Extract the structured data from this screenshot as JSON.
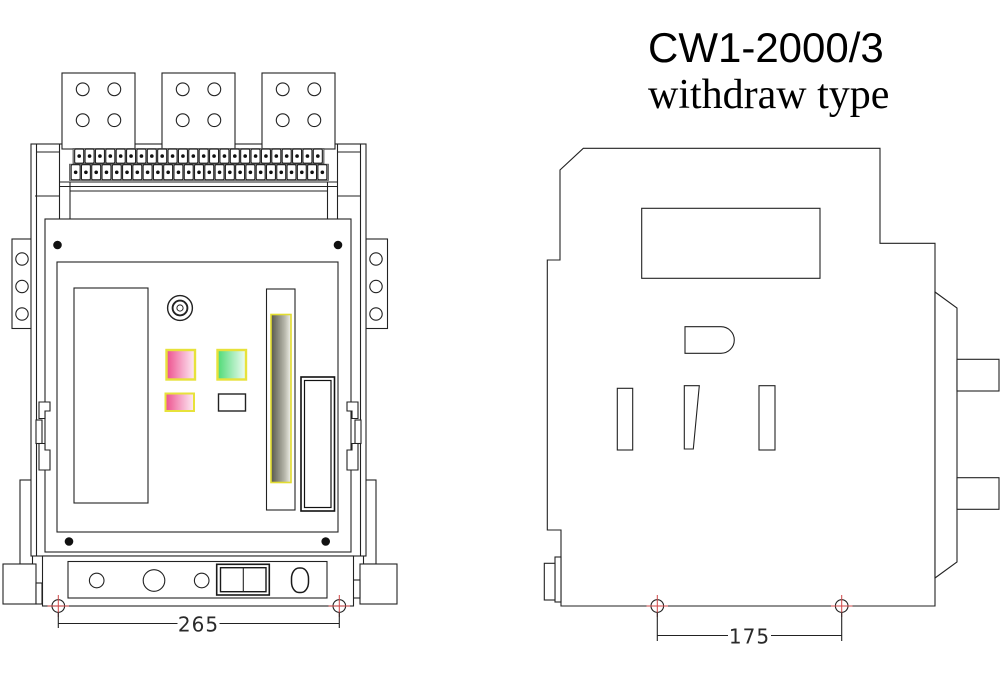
{
  "title": {
    "model": "CW1-2000/3",
    "type_label": "withdraw type"
  },
  "dimensions": {
    "front_mounting_width_mm": "265",
    "side_mounting_width_mm": "175"
  },
  "front_view": {
    "terminal_pad_count": 3,
    "pad_hole_count": 4,
    "terminal_strip_rows": [
      24,
      25
    ],
    "bracket_hole_count": 3,
    "carriage_hole_count": 3
  },
  "colors": {
    "line": "#222222",
    "button_border_yellow": "#e7e23b",
    "button_pink": "#ed4f8c",
    "button_green": "#4eda75",
    "slot_gray_dark": "#57574b",
    "dimension_marker_red": "#cf4747",
    "background": "#ffffff"
  }
}
